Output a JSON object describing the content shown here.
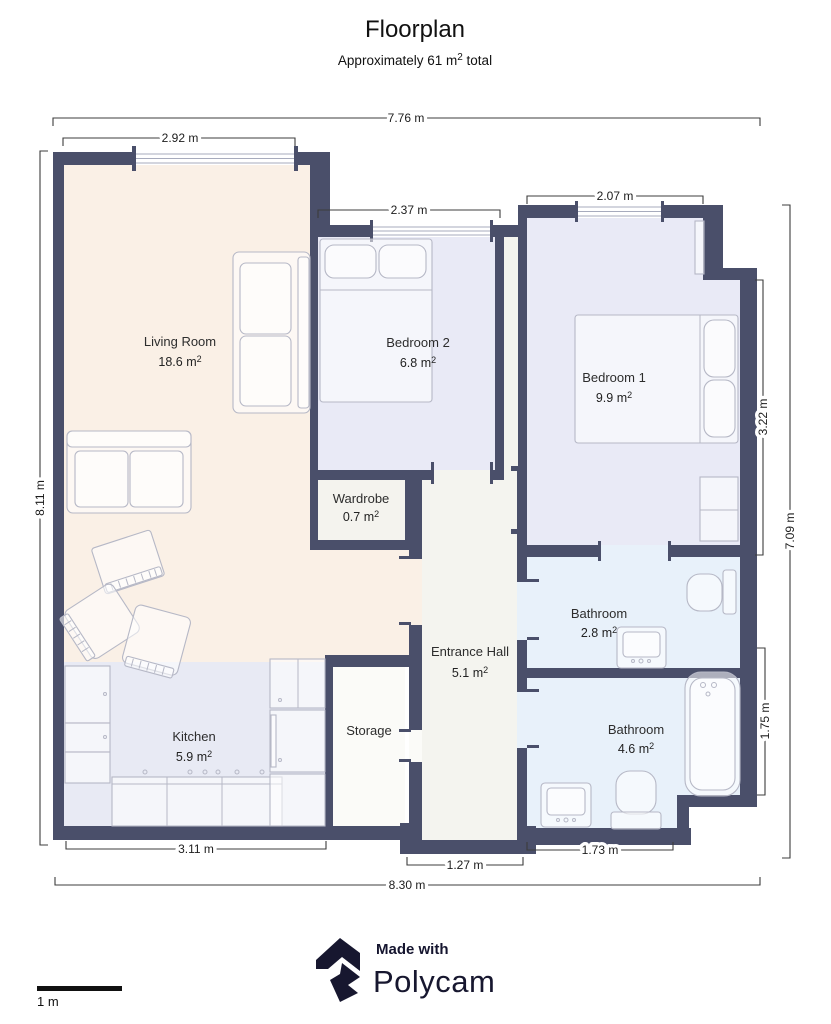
{
  "title": "Floorplan",
  "subtitle": {
    "pre": "Approximately 61 m",
    "sup": "2",
    "post": " total"
  },
  "units": {
    "m_space": " m",
    "sup": "2"
  },
  "rooms": {
    "living": {
      "name": "Living Room",
      "area": "18.6"
    },
    "bedroom2": {
      "name": "Bedroom 2",
      "area": "6.8"
    },
    "bedroom1": {
      "name": "Bedroom 1",
      "area": "9.9"
    },
    "wardrobe": {
      "name": "Wardrobe",
      "area": "0.7"
    },
    "hall": {
      "name": "Entrance Hall",
      "area": "5.1"
    },
    "bath_small": {
      "name": "Bathroom",
      "area": "2.8"
    },
    "bath_large": {
      "name": "Bathroom",
      "area": "4.6"
    },
    "kitchen": {
      "name": "Kitchen",
      "area": "5.9"
    },
    "storage": {
      "name": "Storage"
    }
  },
  "dimensions": {
    "top_overall": "7.76 m",
    "top_living_window": "2.92 m",
    "top_bedroom2": "2.37 m",
    "top_bedroom1": "2.07 m",
    "left_overall": "8.11 m",
    "right_bedroom1": "3.22 m",
    "right_bath": "1.75 m",
    "right_overall": "7.09 m",
    "bottom_kitchen": "3.11 m",
    "bottom_bath": "1.73 m",
    "bottom_hall": "1.27 m",
    "bottom_overall": "8.30 m"
  },
  "scale_bar": {
    "label": "1 m"
  },
  "footer": {
    "made_with": "Made with",
    "brand": "Polycam"
  },
  "colors": {
    "wall": "#4a4f6a",
    "living": "#faf0e6",
    "bedroom": "#e9eaf6",
    "bath": "#e8f1fa",
    "kitchen": "#e8eaf4",
    "hall": "#f4f4ef",
    "wardrobe": "#f4f3ee",
    "storage": "#fbfbf8",
    "furn": "#b6b8c6",
    "window": "#a7abbd",
    "dimline": "#3c3c3c",
    "ink": "#111111",
    "logo": "#17172f"
  }
}
